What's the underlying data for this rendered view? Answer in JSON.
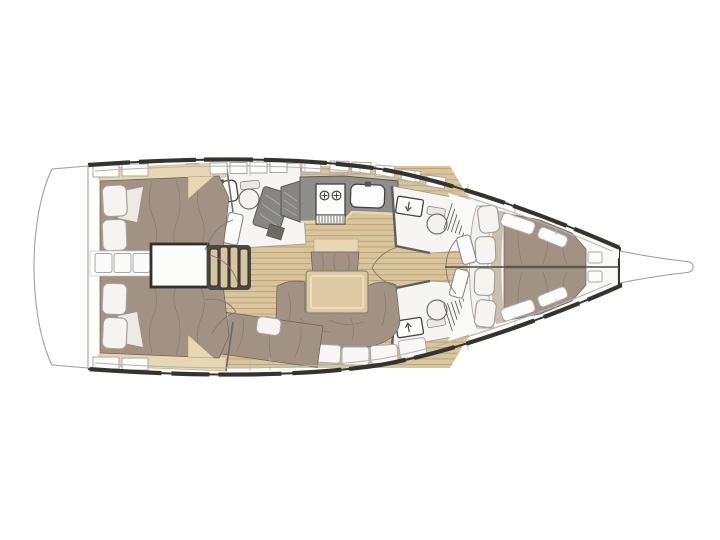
{
  "plan": {
    "vessel": "Sailing yacht interior deck floor plan, bow pointing right, stern with swim platform on the left",
    "orientation": {
      "bow": "right",
      "stern": "left",
      "port_side": "top",
      "starboard_side": "bottom"
    },
    "rooms": [
      {
        "name": "swim-platform",
        "features": []
      },
      {
        "name": "aft-cabin-port",
        "features": [
          "double-berth",
          "two-pillows",
          "wood-headboard-shelf"
        ]
      },
      {
        "name": "aft-cabin-starboard",
        "features": [
          "double-berth",
          "two-pillows",
          "wood-headboard-shelf"
        ]
      },
      {
        "name": "companionway",
        "features": [
          "four-tread-wood-steps",
          "engine-compartment",
          "three-access-hatches"
        ]
      },
      {
        "name": "aft-head-port",
        "features": [
          "washbasin",
          "toilet",
          "tilted-locker-panel",
          "striped-hatch"
        ]
      },
      {
        "name": "galley",
        "features": [
          "two-burner-stove",
          "grill-vent",
          "sink-with-faucet",
          "gray-worktops"
        ]
      },
      {
        "name": "salon",
        "features": [
          "dining-table",
          "u-shaped-settee",
          "center-bench-seat",
          "white-backrest-panels"
        ]
      },
      {
        "name": "mid-cabin-starboard",
        "features": [
          "berth",
          "pillow",
          "entry-steps",
          "door-panel"
        ]
      },
      {
        "name": "forward-head-port",
        "features": [
          "vanity-basin",
          "toilet",
          "shower-grate"
        ]
      },
      {
        "name": "forward-head-starboard",
        "features": [
          "vanity-basin",
          "toilet",
          "shower-grate"
        ]
      },
      {
        "name": "forward-cabin",
        "features": [
          "v-berth-double",
          "four-headboard-cushions",
          "side-lockers",
          "night-shelves"
        ]
      },
      {
        "name": "bow",
        "features": [
          "anchor-sprit"
        ]
      }
    ]
  },
  "palette": {
    "background": "#ffffff",
    "hull_outline": "#35332e",
    "hull_fill": "#fdfdfc",
    "deck_line": "#b5b4b0",
    "wall_gray": "#e9e8e4",
    "room_white": "#f6f5f2",
    "floor_wood": "#d8c49d",
    "floor_wood_line": "#bca173",
    "trim_wood": "#e7d7b3",
    "mattress_taupe": "#a29283",
    "mattress_crease": "#7c6c59",
    "cushion_white": "#f5f4f1",
    "cushion_border": "#a5a19a",
    "counter_gray": "#8f8e8b",
    "module_gray": "#878682",
    "dark_fixture": "#55534e",
    "table_wood": "#ddc9a2",
    "steps_dark": "#4a4843"
  }
}
